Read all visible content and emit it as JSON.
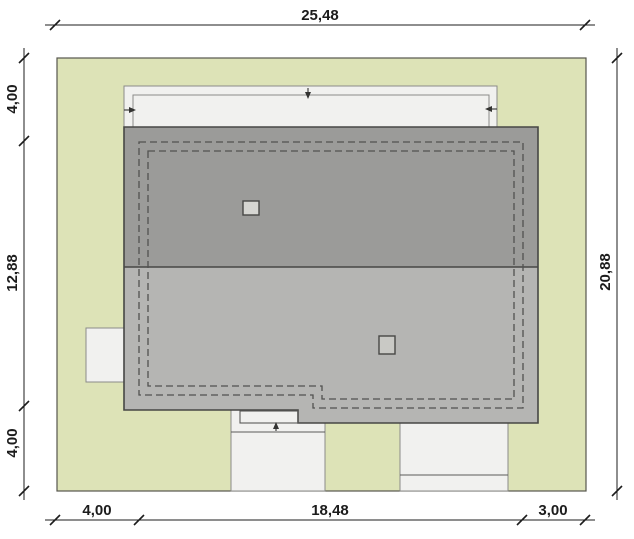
{
  "dimension_labels": {
    "top_total": "25,48",
    "bottom_left": "4,00",
    "bottom_middle": "18,48",
    "bottom_right": "3,00",
    "left_top": "4,00",
    "left_middle": "12,88",
    "left_bottom": "4,00",
    "right_total": "20,88"
  },
  "colors": {
    "background": "#ffffff",
    "plot_fill": "#dde3b7",
    "roof_upper_fill": "#9b9b99",
    "roof_lower_fill": "#b5b5b3",
    "structure_fill": "#f1f1ef",
    "chimney_upper_fill": "#d6d6d2",
    "chimney_lower_fill": "#c9c9c5",
    "dimension_color": "#1c1c1c"
  }
}
